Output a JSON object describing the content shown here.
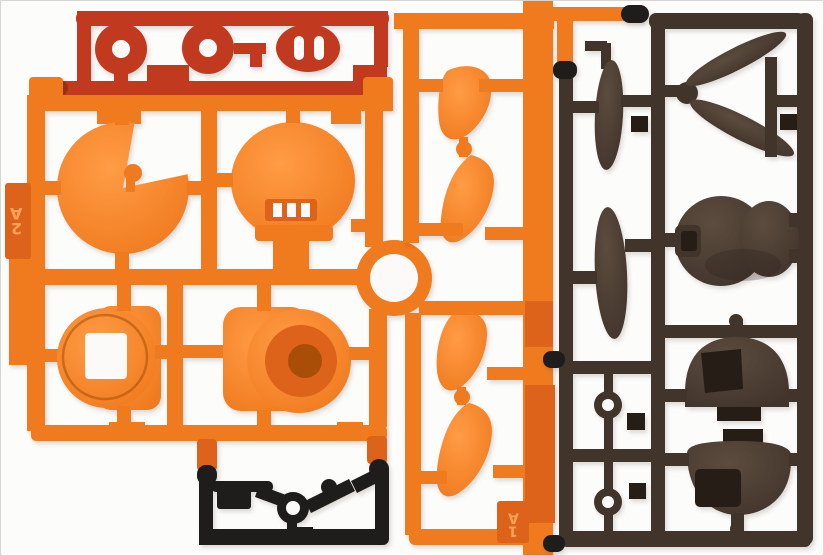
{
  "labels": {
    "runner_left": "A2",
    "runner_center": "A1"
  },
  "colors": {
    "background": "#FCFCFB",
    "border": "#D8D6D3",
    "white": "#FBFAF8",
    "orange": "#F07A1E",
    "orangeHi": "#FF9C45",
    "orangeDark": "#DD621A",
    "orangeDeep": "#A84E07",
    "red": "#C13A1F",
    "redDeep": "#9E2F16",
    "brown": "#41342B",
    "brownHi": "#5C4C3E",
    "brownDeep": "#251D16",
    "black": "#1F1D1B",
    "labelText": "#FFA35C"
  }
}
